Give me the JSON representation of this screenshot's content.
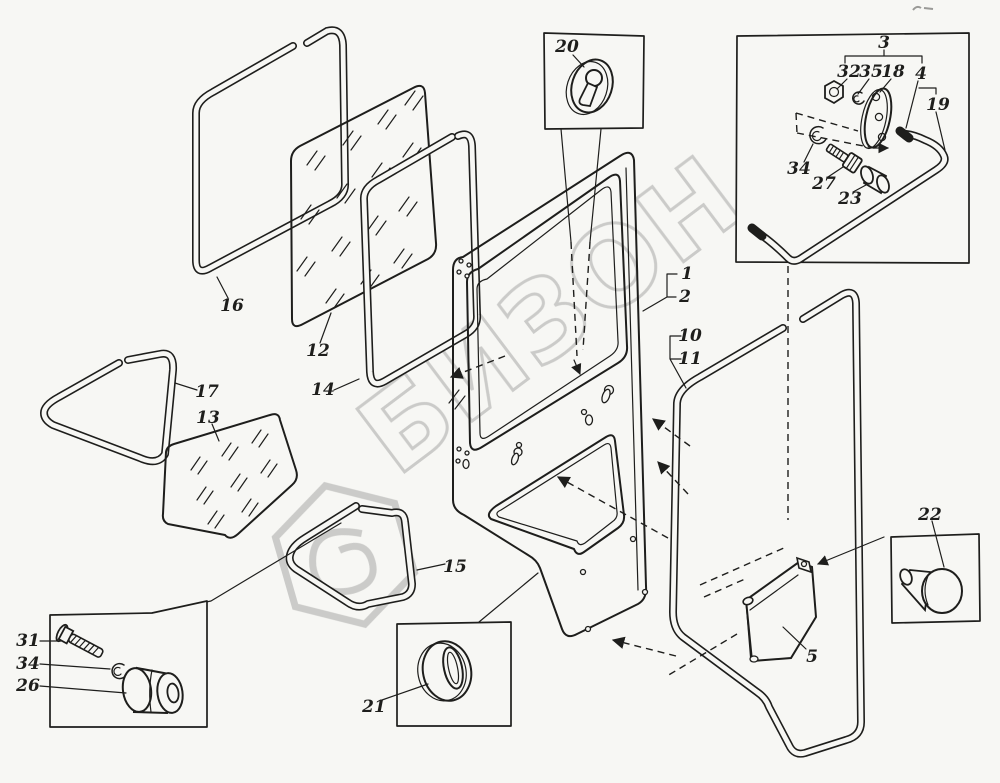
{
  "diagram": {
    "watermark": "БИЗОН",
    "colors": {
      "line": "#1e1e1c",
      "watermark": "#c3c3c1",
      "paper": "#f7f7f4"
    },
    "callouts": [
      {
        "num": "20"
      },
      {
        "num": "3"
      },
      {
        "num": "32"
      },
      {
        "num": "35"
      },
      {
        "num": "18"
      },
      {
        "num": "4"
      },
      {
        "num": "19"
      },
      {
        "num": "34"
      },
      {
        "num": "27"
      },
      {
        "num": "23"
      },
      {
        "num": "16"
      },
      {
        "num": "12"
      },
      {
        "num": "14"
      },
      {
        "num": "17"
      },
      {
        "num": "13"
      },
      {
        "num": "15"
      },
      {
        "num": "1"
      },
      {
        "num": "2"
      },
      {
        "num": "10"
      },
      {
        "num": "11"
      },
      {
        "num": "21"
      },
      {
        "num": "22"
      },
      {
        "num": "5"
      },
      {
        "num": "31"
      },
      {
        "num": "34"
      },
      {
        "num": "26"
      }
    ]
  }
}
